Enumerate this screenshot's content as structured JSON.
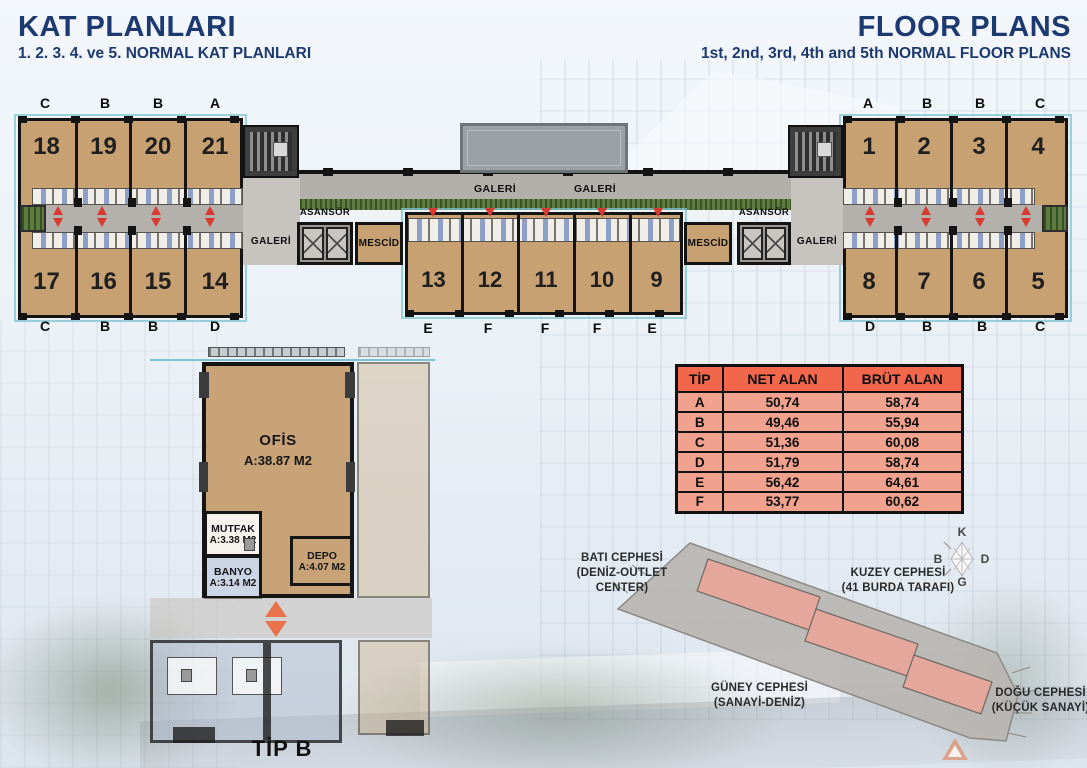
{
  "header": {
    "title_tr": "KAT PLANLARI",
    "subtitle_tr": "1. 2. 3. 4. ve 5. NORMAL KAT PLANLARI",
    "title_en": "FLOOR PLANS",
    "subtitle_en": "1st, 2nd, 3rd, 4th and 5th NORMAL FLOOR PLANS"
  },
  "floor_plan": {
    "left_wing": {
      "top_letters": [
        "C",
        "B",
        "B",
        "A"
      ],
      "top_units": [
        "18",
        "19",
        "20",
        "21"
      ],
      "bottom_units": [
        "17",
        "16",
        "15",
        "14"
      ],
      "bottom_letters": [
        "C",
        "B",
        "B",
        "D"
      ]
    },
    "middle": {
      "gallery_top_labels": [
        "GALERİ",
        "GALERİ"
      ],
      "units": [
        "13",
        "12",
        "11",
        "10",
        "9"
      ],
      "bottom_letters": [
        "E",
        "F",
        "F",
        "F",
        "E"
      ]
    },
    "right_wing": {
      "top_letters": [
        "A",
        "B",
        "B",
        "C"
      ],
      "top_units": [
        "1",
        "2",
        "3",
        "4"
      ],
      "bottom_units": [
        "8",
        "7",
        "6",
        "5"
      ],
      "bottom_letters": [
        "D",
        "B",
        "B",
        "C"
      ]
    },
    "labels": {
      "galeri": "GALERİ",
      "asansor": "ASANSÖR",
      "mescid": "MESCİD"
    }
  },
  "unit_detail": {
    "caption": "TİP B",
    "rooms": {
      "office": {
        "name": "OFİS",
        "area": "A:38.87 M2"
      },
      "kitchen": {
        "name": "MUTFAK",
        "area": "A:3.38 M2"
      },
      "bathroom": {
        "name": "BANYO",
        "area": "A:3.14 M2"
      },
      "storage": {
        "name": "DEPO",
        "area": "A:4.07 M2"
      }
    }
  },
  "area_table": {
    "headers": [
      "TİP",
      "NET ALAN",
      "BRÜT ALAN"
    ],
    "rows": [
      [
        "A",
        "50,74",
        "58,74"
      ],
      [
        "B",
        "49,46",
        "55,94"
      ],
      [
        "C",
        "51,36",
        "60,08"
      ],
      [
        "D",
        "51,79",
        "58,74"
      ],
      [
        "E",
        "56,42",
        "64,61"
      ],
      [
        "F",
        "53,77",
        "60,62"
      ]
    ]
  },
  "site_plan": {
    "facades": {
      "west": {
        "title": "BATI CEPHESİ",
        "subtitle": "(DENİZ-OUTLET CENTER)"
      },
      "north": {
        "title": "KUZEY CEPHESİ",
        "subtitle": "(41 BURDA TARAFI)"
      },
      "south": {
        "title": "GÜNEY CEPHESİ",
        "subtitle": "(SANAYİ-DENİZ)"
      },
      "east": {
        "title": "DOĞU CEPHESİ",
        "subtitle": "(KÜÇÜK SANAYİ)"
      }
    },
    "compass": {
      "north": "K",
      "south": "G",
      "east": "D",
      "west": "B"
    }
  },
  "colors": {
    "title_navy": "#1d3a70",
    "unit_fill": "#c8a173",
    "corridor_gray": "#b3b0ac",
    "wall_black": "#141414",
    "accent_teal": "#7cc4d0",
    "arrow_red": "#d93a2f",
    "arrow_orange": "#e8724a",
    "plant_green": "#5e7c41",
    "table_header_bg": "#f2674b",
    "table_row_bg": "#f0a28e",
    "site_parcel_gray": "#b8b5b1",
    "site_building_pink": "#e8a59a"
  }
}
